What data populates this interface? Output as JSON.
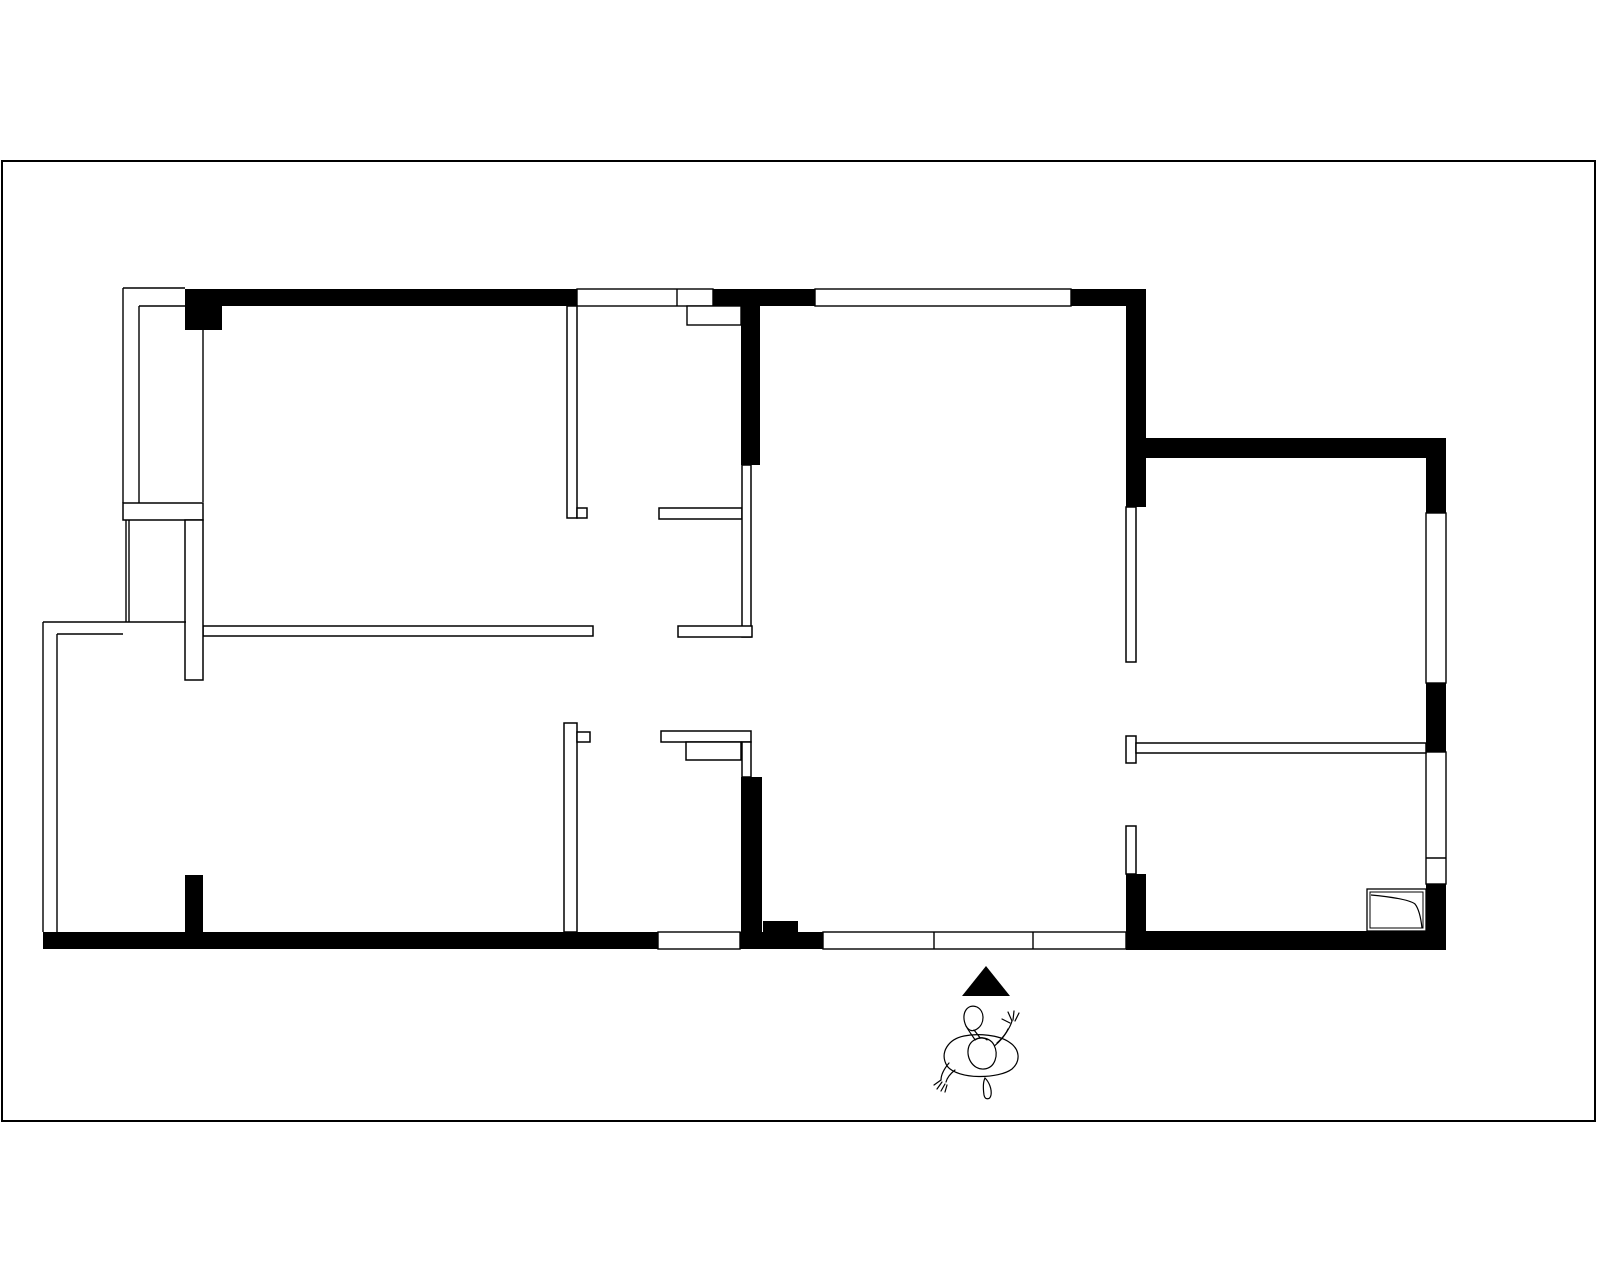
{
  "palette": {
    "ink": "#000000",
    "paper": "#ffffff"
  },
  "canvas": {
    "width": 1600,
    "height": 1280
  },
  "border": {
    "x": 2,
    "y": 161,
    "w": 1593,
    "h": 960,
    "stroke_width": 2
  },
  "floor_plan": {
    "solid_walls": [
      [
        185,
        289,
        392,
        17,
        "north-wall-west-segment"
      ],
      [
        185,
        289,
        37,
        41,
        "north-wall-corner-column"
      ],
      [
        713,
        289,
        102,
        17,
        "north-wall-center-segment"
      ],
      [
        1071,
        289,
        75,
        17,
        "north-wall-east-segment"
      ],
      [
        741,
        306,
        19,
        159,
        "center-partition-upper"
      ],
      [
        1126,
        306,
        20,
        201,
        "bedroom-east-partition"
      ],
      [
        1145,
        438,
        301,
        20,
        "east-room-north-wall"
      ],
      [
        1426,
        458,
        20,
        55,
        "east-exterior-wall-a"
      ],
      [
        1426,
        683,
        20,
        69,
        "east-exterior-wall-b"
      ],
      [
        1426,
        884,
        20,
        66,
        "east-exterior-wall-c"
      ],
      [
        1146,
        931,
        300,
        19,
        "south-wall-east-segment"
      ],
      [
        1126,
        874,
        20,
        76,
        "entry-corner-column"
      ],
      [
        43,
        932,
        615,
        17,
        "south-wall-west-segment"
      ],
      [
        740,
        932,
        83,
        17,
        "south-wall-center-segment"
      ],
      [
        763,
        921,
        35,
        11,
        "south-wall-step"
      ],
      [
        185,
        875,
        18,
        57,
        "interior-column-west"
      ],
      [
        741,
        777,
        21,
        155,
        "center-partition-lower"
      ]
    ],
    "thin_walls": [
      [
        567,
        306,
        10,
        212,
        "bedroom1-partition"
      ],
      [
        577,
        508,
        10,
        10,
        "bedroom1-partition-jamb"
      ],
      [
        659,
        508,
        83,
        11,
        "hall-stub-upper"
      ],
      [
        742,
        465,
        9,
        172,
        "hall-partition-mid"
      ],
      [
        678,
        626,
        74,
        11,
        "hall-stub-lower"
      ],
      [
        203,
        626,
        390,
        10,
        "west-room-divider"
      ],
      [
        564,
        723,
        13,
        209,
        "lower-partition"
      ],
      [
        577,
        732,
        13,
        10,
        "lower-partition-jamb"
      ],
      [
        661,
        731,
        90,
        11,
        "kitchen-stub"
      ],
      [
        686,
        742,
        55,
        18,
        "kitchen-stub-step"
      ],
      [
        742,
        742,
        9,
        35,
        "kitchen-partition-link"
      ],
      [
        1126,
        507,
        10,
        155,
        "east-hall-partition-upper"
      ],
      [
        1126,
        736,
        10,
        27,
        "east-hall-jamb"
      ],
      [
        1136,
        743,
        290,
        10,
        "southeast-room-wall"
      ],
      [
        1126,
        826,
        10,
        48,
        "east-hall-partition-lower"
      ],
      [
        123,
        503,
        80,
        17,
        "balcony-divider-band"
      ],
      [
        185,
        520,
        18,
        160,
        "balcony-pier"
      ]
    ],
    "lines": [
      [
        123,
        288,
        123,
        503,
        "balcony-outer-west"
      ],
      [
        139,
        306,
        139,
        503,
        "balcony-inner-west"
      ],
      [
        123,
        288,
        185,
        288,
        "balcony-outer-north"
      ],
      [
        139,
        306,
        203,
        306,
        "balcony-inner-north"
      ],
      [
        203,
        330,
        203,
        502,
        "balcony-inner-east"
      ],
      [
        126,
        520,
        126,
        622,
        "balcony-lower-west-a"
      ],
      [
        129,
        520,
        129,
        622,
        "balcony-lower-west-b"
      ],
      [
        43,
        622,
        43,
        932,
        "west-exterior-outer"
      ],
      [
        57,
        634,
        57,
        932,
        "west-exterior-inner"
      ],
      [
        43,
        622,
        186,
        622,
        "west-room-north-outer"
      ],
      [
        57,
        634,
        123,
        634,
        "west-room-north-inner"
      ]
    ],
    "windows": [
      {
        "r": [
          577,
          289,
          136,
          17
        ],
        "vx": [
          677
        ],
        "n": "north-window-1"
      },
      {
        "r": [
          815,
          289,
          256,
          17
        ],
        "vx": [],
        "n": "north-window-2"
      },
      {
        "r": [
          687,
          306,
          54,
          19
        ],
        "vx": [],
        "n": "north-window-sill"
      },
      {
        "r": [
          1426,
          513,
          20,
          170
        ],
        "vx": [],
        "n": "east-window-1"
      },
      {
        "r": [
          1426,
          752,
          20,
          132
        ],
        "hy": [
          858
        ],
        "n": "east-window-2"
      },
      {
        "r": [
          658,
          932,
          82,
          17
        ],
        "vx": [],
        "n": "south-window-1"
      },
      {
        "r": [
          823,
          932,
          303,
          17
        ],
        "vx": [
          934,
          1033
        ],
        "n": "entry-door-band"
      }
    ],
    "door_panel": {
      "outer": [
        1367,
        889,
        59,
        42
      ],
      "inner": [
        1370,
        892,
        53,
        36
      ],
      "curve": "M 1371 895 C 1392 897 1410 900 1415 904 C 1419 909 1421 919 1422 928"
    },
    "entrance_marker": {
      "points": "962,996 1010,996 986,966"
    },
    "person_figure": {
      "strokes": [
        {
          "d": "M 947 1066 C 939 1052 949 1039 964 1036 C 978 1033 999 1035 1009 1042 C 1020 1049 1021 1061 1012 1069 C 999 1079 958 1080 947 1066 Z",
          "f": 1
        },
        {
          "d": "M 966 1026 C 960 1013 968 1003 977 1007 C 985 1011 985 1024 977 1029 C 973 1032 969 1031 966 1026 Z",
          "f": 1
        },
        {
          "d": "M 974 1030 C 978 1035 981 1039 984 1043",
          "f": 0
        },
        {
          "d": "M 966 1026 C 970 1033 974 1038 978 1044",
          "f": 0
        },
        {
          "d": "M 997 1043 C 1004 1037 1010 1028 1012 1021",
          "f": 0
        },
        {
          "d": "M 990 1049 C 998 1044 1005 1036 1008 1029",
          "f": 0
        },
        {
          "d": "M 1012 1021 L 1008 1012",
          "f": 0
        },
        {
          "d": "M 1013 1020 L 1014 1011",
          "f": 0
        },
        {
          "d": "M 1015 1021 L 1019 1013",
          "f": 0
        },
        {
          "d": "M 1010 1023 L 1002 1019",
          "f": 0
        },
        {
          "d": "M 969 1046 C 973 1036 989 1035 994 1045 C 999 1055 995 1068 984 1069 C 973 1070 965 1057 969 1046 Z",
          "f": 1
        },
        {
          "d": "M 975 1040 C 979 1037 984 1037 987 1040",
          "f": 0
        },
        {
          "d": "M 949 1063 C 944 1069 941 1075 941 1080",
          "f": 0
        },
        {
          "d": "M 955 1070 C 950 1074 947 1078 946 1082",
          "f": 0
        },
        {
          "d": "M 941 1080 L 934 1085",
          "f": 0
        },
        {
          "d": "M 942 1082 L 937 1089",
          "f": 0
        },
        {
          "d": "M 945 1084 L 941 1091",
          "f": 0
        },
        {
          "d": "M 947 1085 L 945 1092",
          "f": 0
        },
        {
          "d": "M 985 1078 C 989 1082 992 1089 991 1095 C 990 1100 985 1100 984 1095 C 983 1088 983 1082 985 1078 Z",
          "f": 1
        }
      ]
    }
  }
}
